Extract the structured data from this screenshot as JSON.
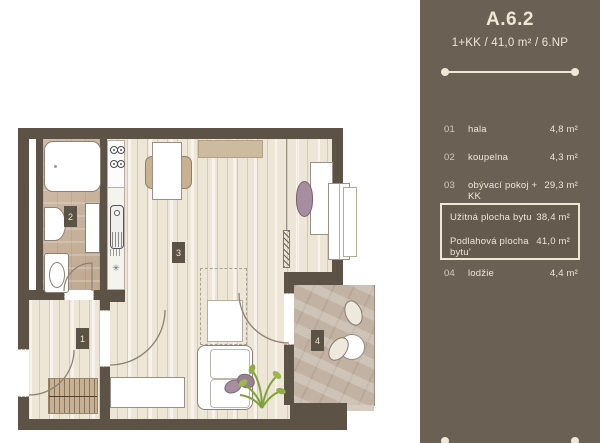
{
  "panel": {
    "title": "A.6.2",
    "subtitle": "1+KK / 41,0 m² / 6.NP",
    "rows": [
      {
        "num": "01",
        "name": "hala",
        "area": "4,8 m²"
      },
      {
        "num": "02",
        "name": "koupelna",
        "area": "4,3 m²"
      },
      {
        "num": "03",
        "name": "obývací pokoj + KK",
        "area": "29,3 m²"
      },
      {
        "num": "04",
        "name": "lodžie",
        "area": "4,4 m²"
      }
    ],
    "summary": [
      {
        "name": "Užitná plocha bytu",
        "area": "38,4 m²"
      },
      {
        "name": "Podlahová plocha bytu’",
        "area": "41,0 m²"
      }
    ],
    "colors": {
      "bg": "#6a6054",
      "text": "#efe6d4"
    }
  },
  "floorplan": {
    "room_labels": [
      {
        "id": "1"
      },
      {
        "id": "2"
      },
      {
        "id": "3"
      },
      {
        "id": "4"
      }
    ],
    "symbols": {
      "kitchen_fixture": "✳"
    },
    "colors": {
      "wall": "#5c5246",
      "wood": "#ede5d6",
      "tile": "#c9b29b",
      "stone": "#c1b2a3",
      "mauve": "#a68da0"
    }
  }
}
